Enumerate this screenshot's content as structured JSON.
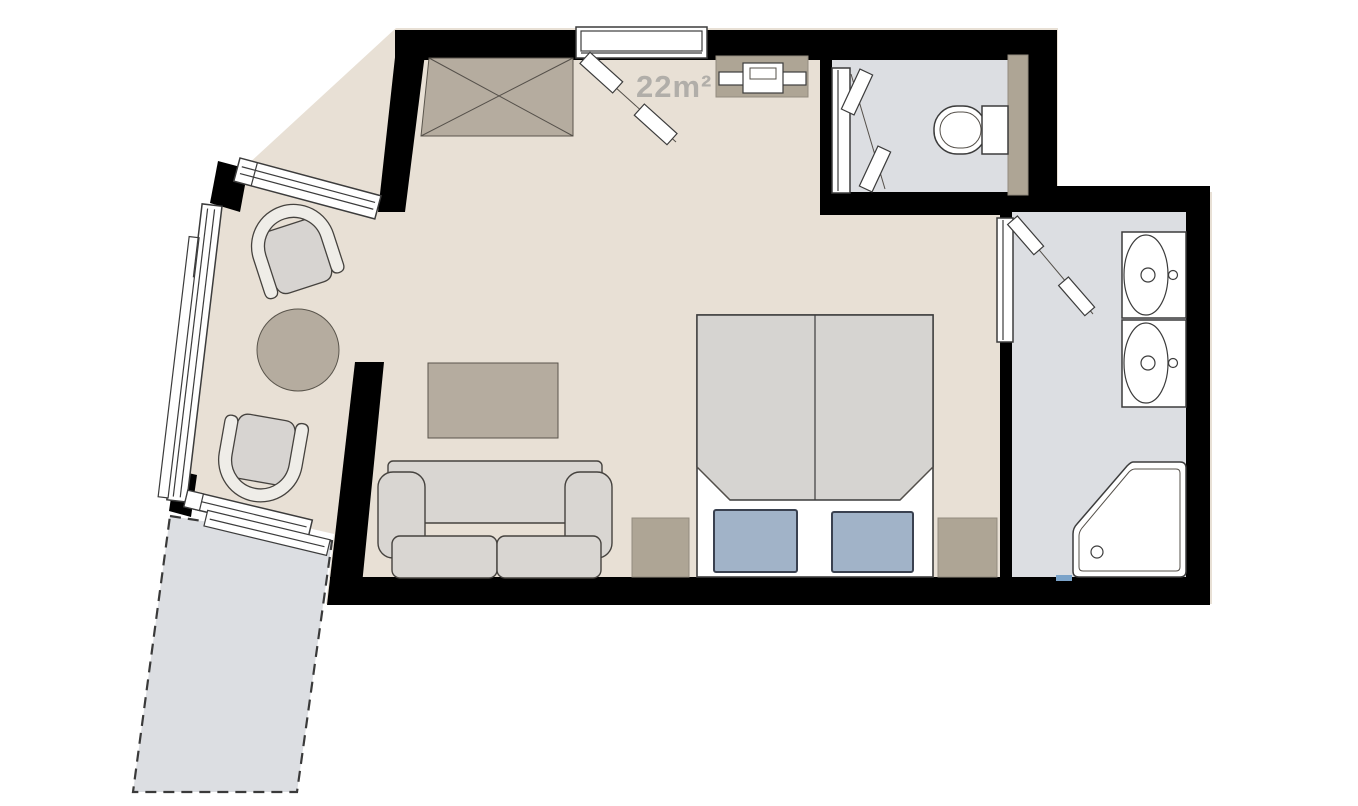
{
  "floor_plan": {
    "area_label": "22m²",
    "rooms": [
      "main-room",
      "sitting-alcove",
      "wc",
      "bathroom",
      "balcony"
    ],
    "furniture": [
      "wardrobe",
      "tv-console",
      "double-bed",
      "bed-pillows",
      "nightstands",
      "sofa",
      "coffee-table",
      "round-side-table",
      "armchair-top",
      "armchair-bottom",
      "toilet",
      "washbasin-upper",
      "washbasin-lower",
      "corner-bathtub"
    ],
    "openings": [
      "entrance-window",
      "entrance-door",
      "alcove-top-window",
      "alcove-side-windows",
      "balcony-window",
      "wc-door",
      "bathroom-door"
    ],
    "colors": {
      "wall": "#000000",
      "room_floor": "#e8e0d5",
      "wet_room_floor": "#dcdee2",
      "balcony_floor": "#dcdee2",
      "furniture_tan": "#b5ac9f",
      "upholstery_gray": "#d9d6d2",
      "pillow_blue": "#a1b3c8",
      "area_label_gray": "#b1aea9"
    }
  }
}
